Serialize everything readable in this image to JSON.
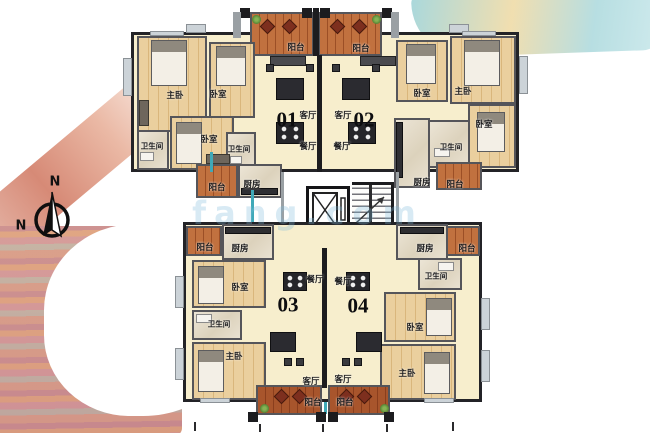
{
  "labels": {
    "master": "主卧",
    "bedroom": "卧室",
    "bathroom": "卫生间",
    "living": "客厅",
    "dining": "餐厅",
    "kitchen": "厨房",
    "balcony": "阳台"
  },
  "units": [
    {
      "number": "01"
    },
    {
      "number": "02"
    },
    {
      "number": "03"
    },
    {
      "number": "04"
    }
  ],
  "compass": {
    "north": "N"
  },
  "watermark": {
    "text": "fang.com"
  },
  "colors": {
    "wall_dark": "#1c1c1f",
    "wall_gray": "#9aa0a4",
    "bedroom_floor": "#eacf9e",
    "living_floor": "#f7eecd",
    "balcony_deck": "#b05a2e",
    "tile_floor": "#e9e2d2",
    "pipe_teal": "#3fa9b8",
    "wash_red": "#cd7257",
    "wash_aqua": "#a5d6da",
    "wash_sand": "#eed9a2"
  }
}
